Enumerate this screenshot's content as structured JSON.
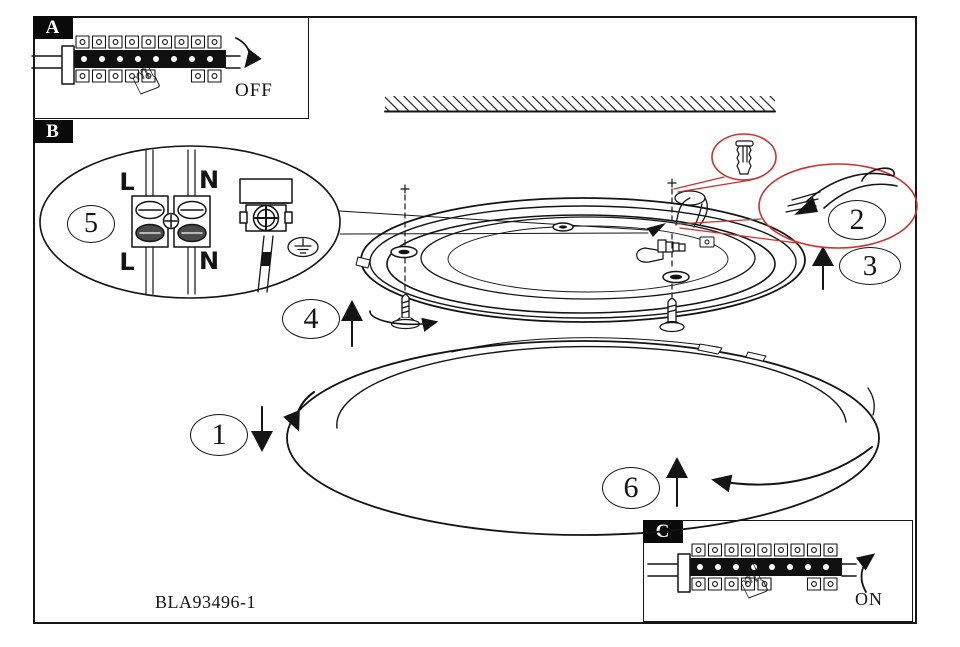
{
  "figure": {
    "part_number": "BLA93496-1"
  },
  "panels": {
    "a": {
      "label": "A",
      "switch_state": "OFF"
    },
    "b": {
      "label": "B"
    },
    "c": {
      "label": "C",
      "switch_state": "ON"
    }
  },
  "wiring": {
    "live_top": "L",
    "neutral_top": "N",
    "live_bottom": "L",
    "neutral_bottom": "N"
  },
  "steps": [
    "1",
    "2",
    "3",
    "4",
    "5",
    "6"
  ],
  "icons": {
    "pointing_hand": "☝"
  },
  "colors": {
    "line": "#141414",
    "highlight_red": "#c53430"
  }
}
